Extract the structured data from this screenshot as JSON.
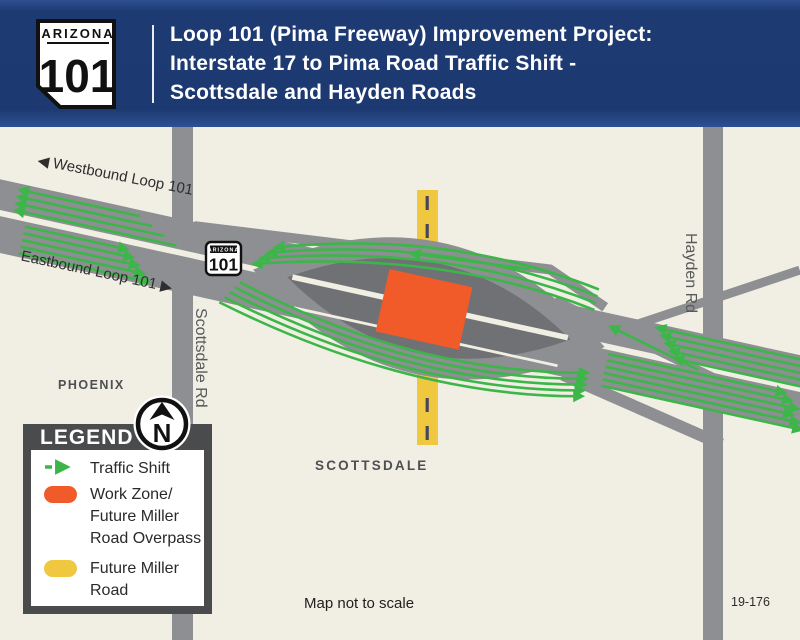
{
  "header": {
    "shield": {
      "state": "ARIZONA",
      "number": "101"
    },
    "title_lines": [
      "Loop 101 (Pima Freeway) Improvement Project:",
      "Interstate 17 to Pima Road Traffic Shift -",
      "Scottsdale and Hayden Roads"
    ]
  },
  "map": {
    "shield": {
      "state": "ARIZONA",
      "number": "101"
    },
    "labels": {
      "westbound": "◀ Westbound Loop 101",
      "eastbound": "Eastbound Loop 101 ▶",
      "phoenix": "PHOENIX",
      "scottsdale_city": "SCOTTSDALE",
      "scottsdale_rd": "Scottsdale Rd",
      "hayden_rd": "Hayden Rd",
      "map_note": "Map not to scale",
      "doc_number": "19-176"
    },
    "colors": {
      "header_navy": "#1E3A72",
      "background_cream": "#F1EEE3",
      "road_gray": "#8D8F92",
      "closed_road_dark_gray": "#6F7174",
      "work_zone_orange": "#F15A29",
      "future_road_yellow": "#EFC83F",
      "traffic_shift_green": "#3CB649"
    }
  },
  "north_arrow": {
    "letter": "N"
  },
  "legend": {
    "title": "LEGEND",
    "items": [
      {
        "symbol": "traffic-shift-arrow",
        "label": "Traffic Shift"
      },
      {
        "symbol": "work-zone-swatch",
        "lines": [
          "Work Zone/",
          "Future Miller",
          "Road Overpass"
        ]
      },
      {
        "symbol": "future-miller-road-swatch",
        "lines": [
          "Future Miller",
          "Road"
        ]
      }
    ]
  }
}
